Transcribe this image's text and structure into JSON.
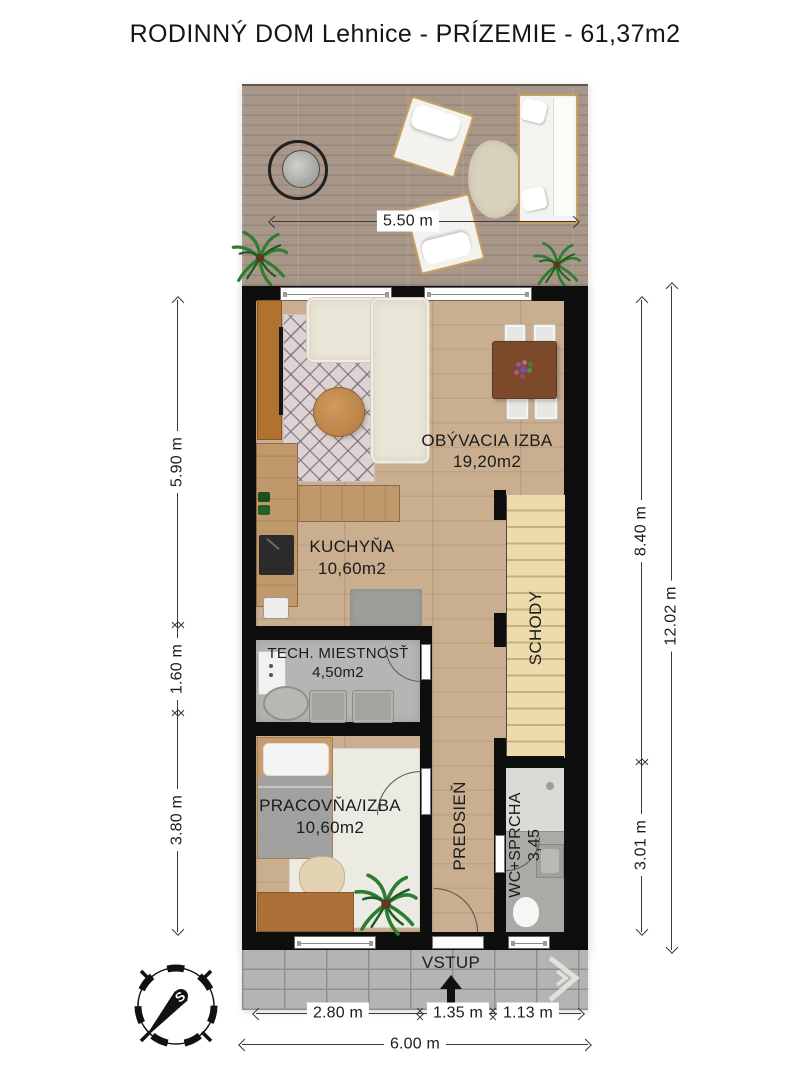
{
  "title": "RODINNÝ DOM Lehnice - PRÍZEMIE - 61,37m2",
  "terrace": {
    "dim": "5.50 m"
  },
  "rooms": {
    "living": {
      "name": "OBÝVACIA IZBA",
      "area": "19,20m2"
    },
    "kitchen": {
      "name": "KUCHYŇA",
      "area": "10,60m2"
    },
    "tech": {
      "name": "TECH. MIESTNOSŤ",
      "area": "4,50m2"
    },
    "study": {
      "name": "PRACOVŇA/IZBA",
      "area": "10,60m2"
    },
    "hall": {
      "name": "PREDSIEŇ"
    },
    "bath": {
      "name": "WC+SPRCHA",
      "area": "3,45"
    },
    "stairs": {
      "name": "SCHODY"
    }
  },
  "entrance": {
    "label": "VSTUP"
  },
  "dims": {
    "left": [
      "5.90 m",
      "1.60 m",
      "3.80 m"
    ],
    "right": [
      "8.40 m",
      "3.01 m"
    ],
    "right_total": "12.02 m",
    "bottom": [
      "2.80 m",
      "1.35 m",
      "1.13 m"
    ],
    "bottom_total": "6.00 m"
  },
  "compass": {
    "north_label": "S"
  },
  "colors": {
    "wall": "#0e0e0e",
    "floor_wood": "#c6aa89",
    "terrace_deck": "#a29188",
    "stairs": "#e9d6a6",
    "pavement": "#b4b4b2",
    "accent_wood": "#b0712f"
  }
}
